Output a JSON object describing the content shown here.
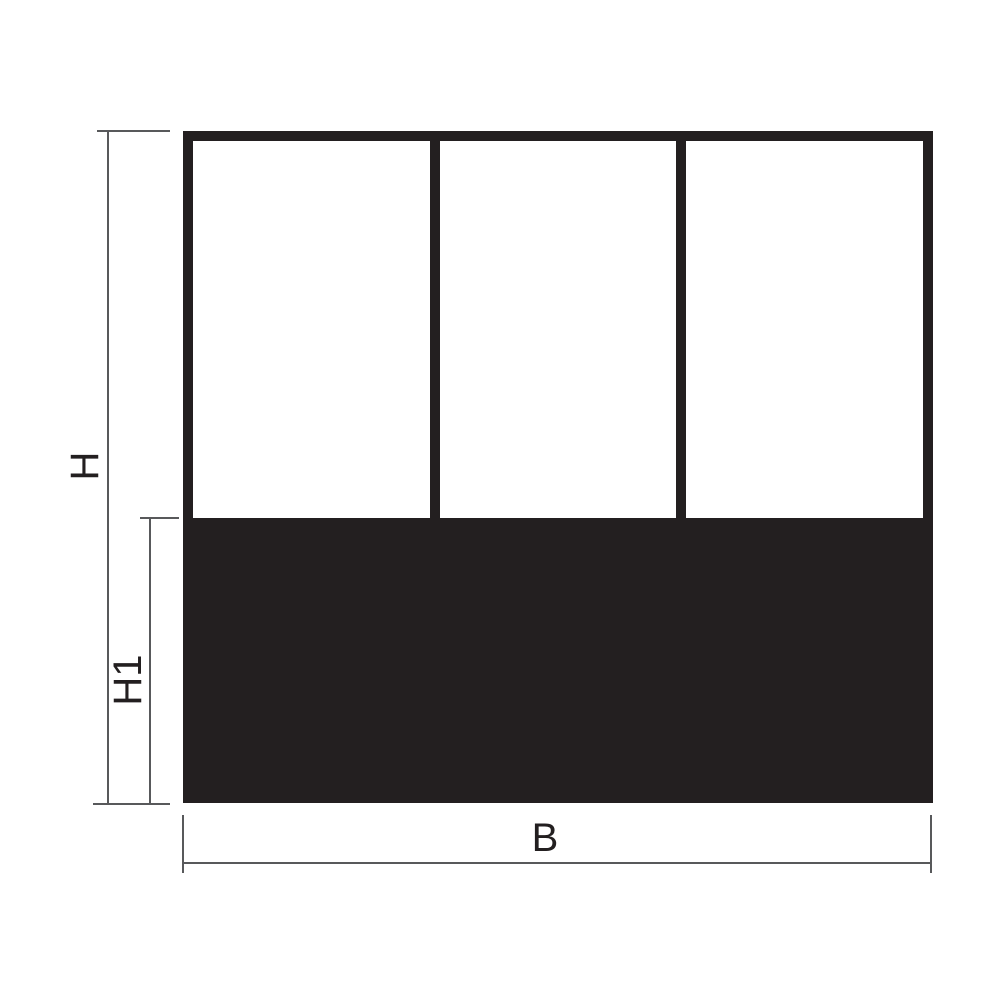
{
  "diagram": {
    "kind": "dimension-drawing",
    "panel_count": 3,
    "labels": {
      "total_height": "H",
      "base_height": "H1",
      "width": "B"
    },
    "colors": {
      "frame": "#231f20",
      "panel": "#ffffff",
      "dimension_line": "#58595b",
      "text": "#231f20",
      "background": "#ffffff"
    }
  }
}
